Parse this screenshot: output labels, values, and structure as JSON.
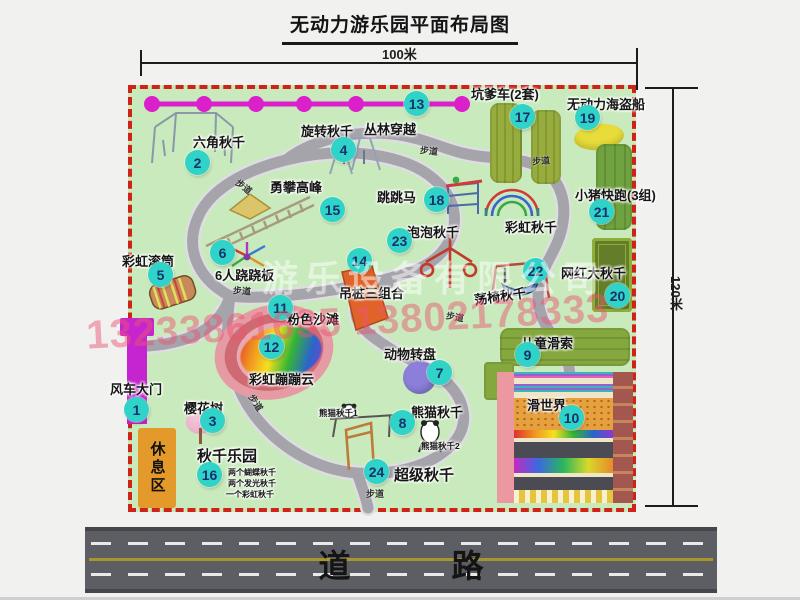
{
  "title": "无动力游乐园平面布局图",
  "dimensions": {
    "width": "100米",
    "height": "120米"
  },
  "road_label": "道 路",
  "map": {
    "walkway": "步道",
    "rest_area": "休息区",
    "watermark_company": "游乐设备有限公司",
    "watermark_phone": "13233861635 13802178333"
  },
  "extra_labels": {
    "rainbow_swing": "彩虹秋千",
    "panda_swing_1": "熊猫秋千1",
    "panda_swing_2": "熊猫秋千2"
  },
  "swing_park_notes": [
    "两个蝴蝶秋千",
    "两个发光秋千",
    "一个彩虹秋千"
  ],
  "attractions": [
    {
      "num": "1",
      "label": "风车大门"
    },
    {
      "num": "2",
      "label": "六角秋千"
    },
    {
      "num": "3",
      "label": "樱花树"
    },
    {
      "num": "4",
      "label": "旋转秋千"
    },
    {
      "num": "5",
      "label": "彩虹滚筒"
    },
    {
      "num": "6",
      "label": "6人跷跷板"
    },
    {
      "num": "7",
      "label": "动物转盘"
    },
    {
      "num": "8",
      "label": "熊猫秋千"
    },
    {
      "num": "9",
      "label": "儿童滑索"
    },
    {
      "num": "10",
      "label": "滑世界"
    },
    {
      "num": "11",
      "label": "粉色沙滩"
    },
    {
      "num": "12",
      "label": "彩虹蹦蹦云"
    },
    {
      "num": "13",
      "label": "丛林穿越"
    },
    {
      "num": "14",
      "label": "吊桩三组合"
    },
    {
      "num": "15",
      "label": "勇攀高峰"
    },
    {
      "num": "16",
      "label": "秋千乐园"
    },
    {
      "num": "17",
      "label": "坑爹车(2套)"
    },
    {
      "num": "18",
      "label": "跳跳马"
    },
    {
      "num": "19",
      "label": "无动力海盗船"
    },
    {
      "num": "20",
      "label": "网红大秋千"
    },
    {
      "num": "21",
      "label": "小猪快跑(3组)"
    },
    {
      "num": "22",
      "label": "荡椅秋千"
    },
    {
      "num": "23",
      "label": "泡泡秋千"
    },
    {
      "num": "24",
      "label": "超级秋千"
    }
  ],
  "colors": {
    "map_bg": "#c8eabc",
    "border_red": "#cf2318",
    "marker_teal": "#2fd3c7",
    "chain_magenta": "#db1fcb",
    "gate_magenta": "#c525cf",
    "rest_orange": "#e49a2b",
    "road_gray": "#5d5d64",
    "path_gray": "#a4a4aa"
  }
}
